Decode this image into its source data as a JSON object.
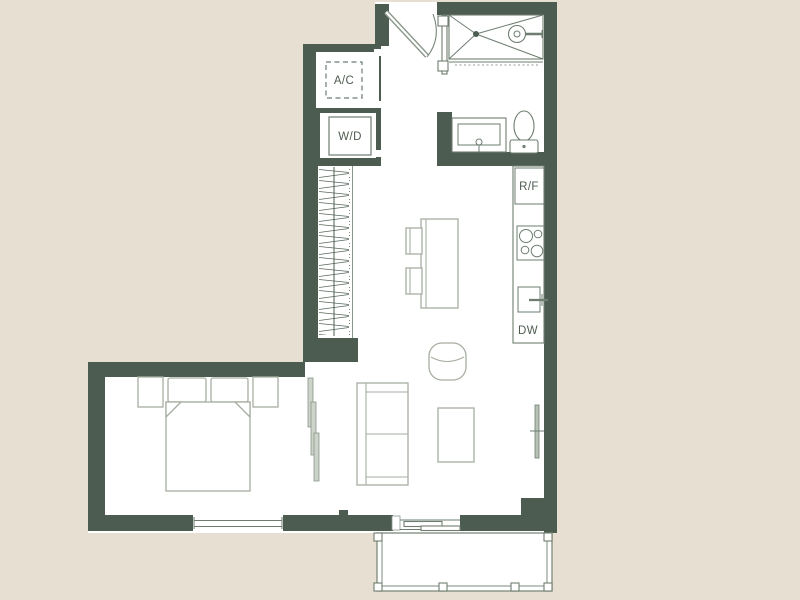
{
  "labels": {
    "ac": "A/C",
    "wd": "W/D",
    "rf": "R/F",
    "dw": "DW"
  },
  "colors": {
    "background": "#e7dfd2",
    "wall": "#4d5c50",
    "floor": "#ffffff",
    "fixture_line": "#6e7d70",
    "furniture_line": "#a6aea2",
    "label_text": "#4d5c50",
    "door_panel": "#ccd3c9"
  },
  "fixtures": {
    "utility": [
      "ac-unit",
      "washer-dryer"
    ],
    "bathroom": [
      "shower",
      "shower-head",
      "vanity-sink",
      "toilet"
    ],
    "kitchen": [
      "refrigerator",
      "stove",
      "kitchen-sink",
      "dishwasher",
      "kitchen-island",
      "bar-stools"
    ],
    "living": [
      "armchair",
      "sofa",
      "coffee-table"
    ],
    "bedroom": [
      "bed",
      "pillows",
      "nightstands",
      "closet",
      "sliding-door",
      "window"
    ],
    "exterior": [
      "entry-door",
      "balcony",
      "balcony-sliding-door",
      "railing"
    ]
  }
}
